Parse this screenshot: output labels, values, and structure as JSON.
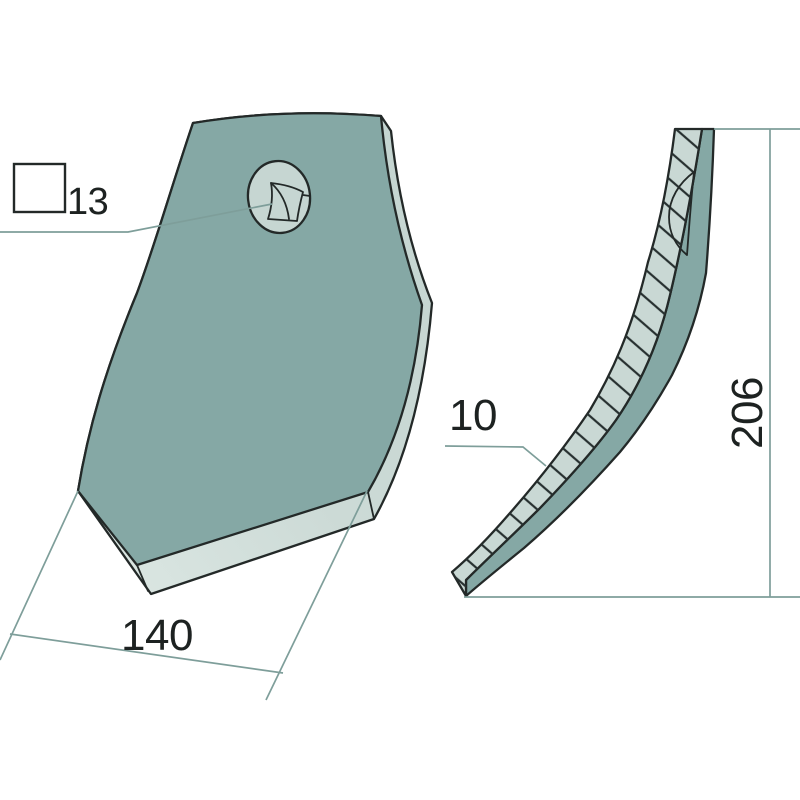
{
  "drawing": {
    "colors": {
      "background": "#ffffff",
      "face": "#85a8a5",
      "edge_band": "#c9d8d4",
      "edge_band_light": "#dde8e4",
      "countersink": "#c6d6d2",
      "outline": "#232928",
      "dimension_lines": "#7e9e9a",
      "hatch_lines": "#273030",
      "text": "#1d2221"
    },
    "dimensions": {
      "square_hole": {
        "label": "13",
        "symbol": "square-hole-symbol"
      },
      "width": {
        "label": "140"
      },
      "thickness": {
        "label": "10"
      },
      "length": {
        "label": "206"
      }
    }
  }
}
